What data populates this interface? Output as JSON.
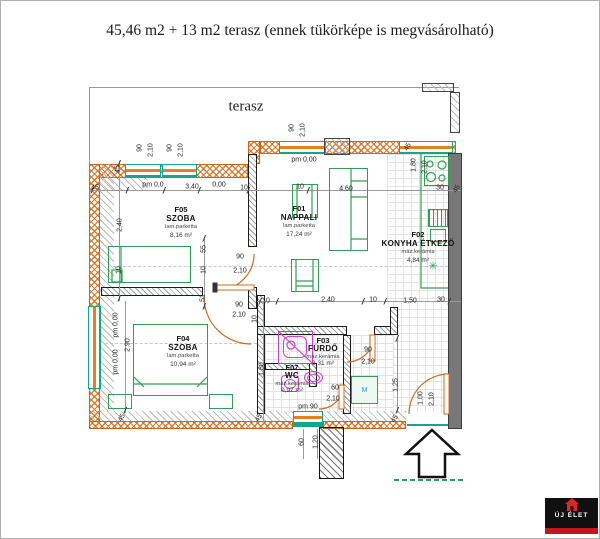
{
  "title": "45,46 m2 + 13 m2 terasz (ennek tükörképe is megvásárolható)",
  "plan": {
    "terrace_label": "terasz",
    "washing_machine_label": "M",
    "floor_drain_icon": "✳",
    "rooms": [
      {
        "id": "F05",
        "name": "SZOBA",
        "floor": "lam.parketta",
        "area": "8,16 m²",
        "cx": 180,
        "cy": 204
      },
      {
        "id": "F01",
        "name": "NAPPALI",
        "floor": "lam.parketta",
        "area": "17,24 m²",
        "cx": 298,
        "cy": 203
      },
      {
        "id": "F02",
        "name": "KONYHA ÉTKEZŐ",
        "floor": "máz.kerámia",
        "area": "4,84 m²",
        "cx": 417,
        "cy": 229
      },
      {
        "id": "F04",
        "name": "SZOBA",
        "floor": "lam.parketta",
        "area": "10,94 m²",
        "cx": 182,
        "cy": 333
      },
      {
        "id": "F03",
        "name": "FÜRDŐ",
        "floor": "máz.kerámia",
        "area": "3,31 m²",
        "cx": 322,
        "cy": 336,
        "compact": true
      },
      {
        "id": "F07",
        "name": "WC",
        "floor": "máz.kerámia",
        "area": "0,97 m²",
        "cx": 291,
        "cy": 363,
        "compact": true
      }
    ],
    "dimensions": [
      {
        "t": "45",
        "x": 94,
        "y": 187
      },
      {
        "t": "45",
        "x": 117,
        "y": 168,
        "r": -90
      },
      {
        "t": "pm 0,0",
        "x": 152,
        "y": 184
      },
      {
        "t": "3,40",
        "x": 191,
        "y": 186
      },
      {
        "t": "0,00",
        "x": 218,
        "y": 184
      },
      {
        "t": "10",
        "x": 243,
        "y": 187
      },
      {
        "t": "10",
        "x": 299,
        "y": 186
      },
      {
        "t": "90",
        "x": 139,
        "y": 147,
        "r": -90
      },
      {
        "t": "2,10",
        "x": 150,
        "y": 149,
        "r": -90
      },
      {
        "t": "90",
        "x": 169,
        "y": 147,
        "r": -90
      },
      {
        "t": "2,10",
        "x": 180,
        "y": 149,
        "r": -90
      },
      {
        "t": "90",
        "x": 291,
        "y": 127,
        "r": -90
      },
      {
        "t": "2,10",
        "x": 302,
        "y": 129,
        "r": -90
      },
      {
        "t": "pm 0,00",
        "x": 303,
        "y": 159
      },
      {
        "t": "45",
        "x": 407,
        "y": 146,
        "r": -60
      },
      {
        "t": "1,80",
        "x": 413,
        "y": 164,
        "r": -90
      },
      {
        "t": "2,10",
        "x": 424,
        "y": 166,
        "r": -90
      },
      {
        "t": "4,60",
        "x": 345,
        "y": 188
      },
      {
        "t": "30",
        "x": 439,
        "y": 187
      },
      {
        "t": "45",
        "x": 456,
        "y": 188,
        "r": -60
      },
      {
        "t": "2,40",
        "x": 119,
        "y": 224,
        "r": -90
      },
      {
        "t": "10",
        "x": 118,
        "y": 269,
        "r": -90
      },
      {
        "t": "55",
        "x": 203,
        "y": 248,
        "r": -90
      },
      {
        "t": "10",
        "x": 203,
        "y": 269,
        "r": -90
      },
      {
        "t": "51",
        "x": 202,
        "y": 297,
        "r": -90
      },
      {
        "t": "90",
        "x": 239,
        "y": 256
      },
      {
        "t": "2,10",
        "x": 239,
        "y": 270
      },
      {
        "t": "90",
        "x": 238,
        "y": 304
      },
      {
        "t": "2,10",
        "x": 238,
        "y": 314
      },
      {
        "t": "10",
        "x": 254,
        "y": 318,
        "r": -90
      },
      {
        "t": "10",
        "x": 265,
        "y": 300
      },
      {
        "t": "2,40",
        "x": 327,
        "y": 299
      },
      {
        "t": "10",
        "x": 372,
        "y": 299
      },
      {
        "t": "1,50",
        "x": 409,
        "y": 300
      },
      {
        "t": "30",
        "x": 440,
        "y": 299
      },
      {
        "t": "pm 0,00",
        "x": 115,
        "y": 324,
        "r": -90
      },
      {
        "t": "pm 0,00",
        "x": 115,
        "y": 361,
        "r": -90
      },
      {
        "t": "2,90",
        "x": 127,
        "y": 344,
        "r": -90
      },
      {
        "t": "1,80",
        "x": 261,
        "y": 368,
        "r": -90
      },
      {
        "t": "45",
        "x": 121,
        "y": 417,
        "r": -60
      },
      {
        "t": "45",
        "x": 258,
        "y": 417,
        "r": -60
      },
      {
        "t": "90",
        "x": 367,
        "y": 349
      },
      {
        "t": "2,10",
        "x": 367,
        "y": 361
      },
      {
        "t": "60",
        "x": 334,
        "y": 387
      },
      {
        "t": "2,10",
        "x": 332,
        "y": 398
      },
      {
        "t": "pm 90",
        "x": 307,
        "y": 406
      },
      {
        "t": "1,25",
        "x": 395,
        "y": 384,
        "r": -90
      },
      {
        "t": "1,00",
        "x": 420,
        "y": 397,
        "r": -90
      },
      {
        "t": "2,10",
        "x": 431,
        "y": 398,
        "r": -90
      },
      {
        "t": "45",
        "x": 394,
        "y": 418,
        "r": -60
      },
      {
        "t": "60",
        "x": 301,
        "y": 441,
        "r": -90
      },
      {
        "t": "1,20",
        "x": 315,
        "y": 441,
        "r": -90
      }
    ],
    "ticks": [
      [
        91,
        190
      ],
      [
        126,
        190
      ],
      [
        163,
        190
      ],
      [
        198,
        190
      ],
      [
        247,
        190
      ],
      [
        307,
        190
      ],
      [
        259,
        301
      ],
      [
        276,
        301
      ],
      [
        362,
        301
      ],
      [
        384,
        301
      ],
      [
        448,
        301
      ],
      [
        118,
        163
      ],
      [
        118,
        298
      ],
      [
        203,
        238
      ],
      [
        203,
        306
      ],
      [
        124,
        410
      ],
      [
        396,
        338
      ],
      [
        396,
        410
      ]
    ]
  },
  "logo": {
    "name": "ÚJ ÉLET"
  }
}
